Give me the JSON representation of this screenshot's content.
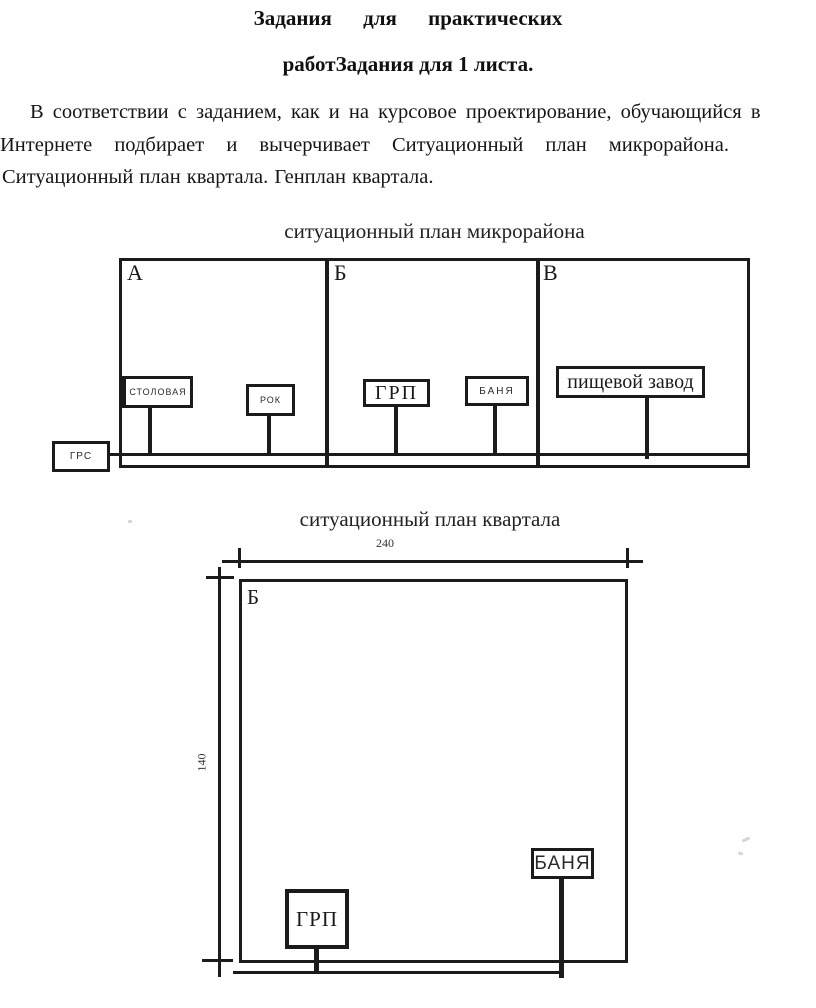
{
  "document": {
    "title_line1": "Задания для практических",
    "title_line2": "работЗадания для 1 листа.",
    "paragraph_line1": "В соответствии с заданием, как и на курсовое проектирование, обучающийся в",
    "paragraph_line2": "Интернете подбирает и вычерчивает Ситуационный план микрорайона.",
    "paragraph_line3": "Ситуационный план квартала. Генплан квартала."
  },
  "diagram1": {
    "title": "ситуационный план микрорайона",
    "section_a": "А",
    "section_b": "Б",
    "section_v": "В",
    "stolovaya": "СТОЛОВАЯ",
    "rok": "РОК",
    "grp": "ГРП",
    "banya": "БАНЯ",
    "food_plant": "пищевой завод",
    "grs": "ГРС"
  },
  "diagram2": {
    "title": "ситуационный план квартала",
    "width_dim": "240",
    "height_dim": "140",
    "section_b": "Б",
    "grp": "ГРП",
    "banya": "БАНЯ"
  }
}
